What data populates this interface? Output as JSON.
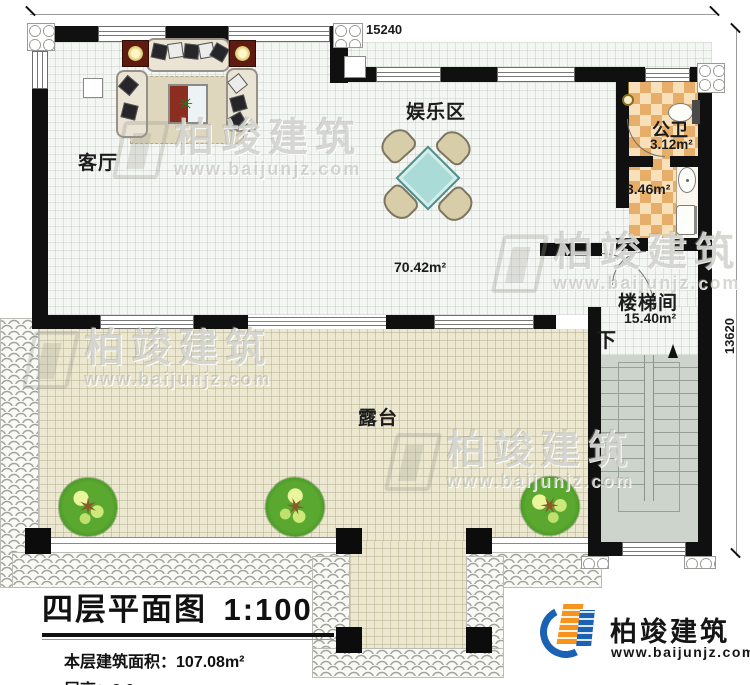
{
  "drawing": {
    "dimensions": {
      "top": "15240",
      "right": "13620"
    },
    "rooms": {
      "living": {
        "label": "客厅"
      },
      "entertainment": {
        "label": "娱乐区"
      },
      "open_area": {
        "area": "70.42m²"
      },
      "public_bath": {
        "label": "公卫",
        "area": "3.12m²"
      },
      "bath_anteroom": {
        "area": "3.46m²"
      },
      "stairwell": {
        "label": "楼梯间",
        "area": "15.40m²",
        "direction": "下"
      },
      "terrace": {
        "label": "露台"
      }
    }
  },
  "title_block": {
    "title": "四层平面图",
    "scale": "1:100",
    "area_label": "本层建筑面积：",
    "area_value": "107.08m²",
    "height_label": "层高：",
    "height_value": "3.0m"
  },
  "brand": {
    "name": "柏竣建筑",
    "url": "www.baijunjz.com"
  },
  "watermark": {
    "name": "柏竣建筑",
    "url": "www.baijunjz.com"
  },
  "colors": {
    "wall": "#101010",
    "terrace_floor": "#ebe7d0",
    "bath_floor": "#e7ae6a",
    "stairs_floor": "#cdd4cc",
    "table_top": "#aadbd6",
    "logo_blue": "#1b62b5",
    "logo_orange": "#f7941d"
  }
}
